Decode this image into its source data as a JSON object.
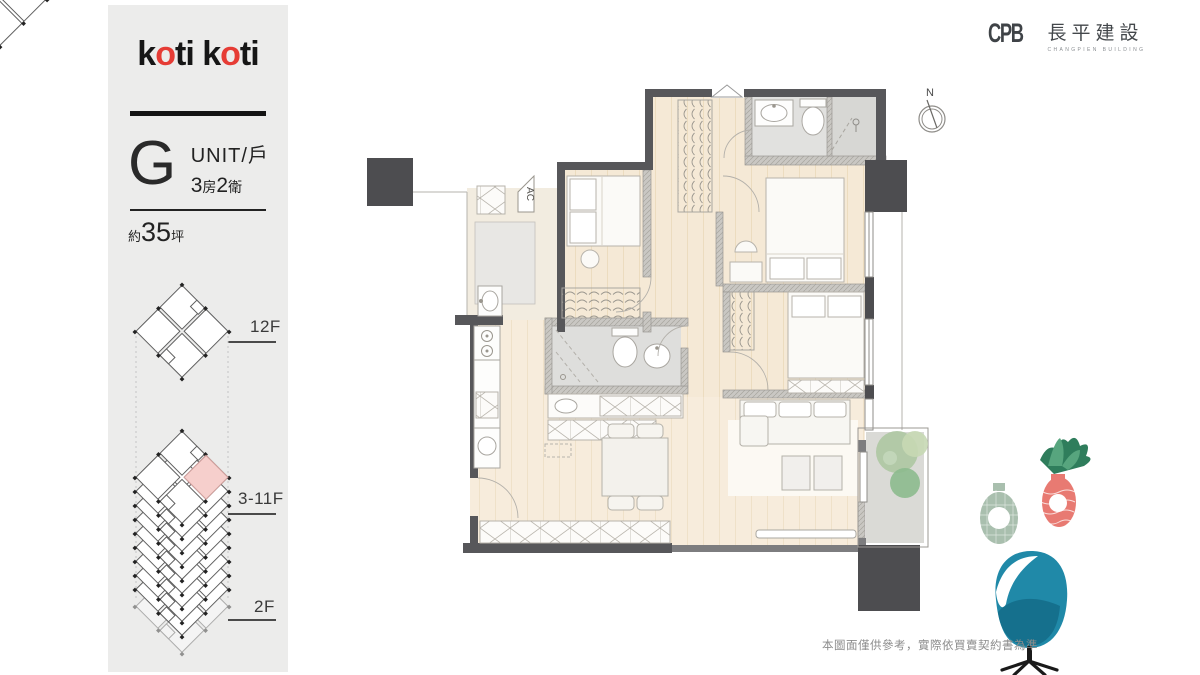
{
  "sidebar": {
    "logo": {
      "p1": "k",
      "p2": "o",
      "p3": "ti k",
      "p4": "o",
      "p5": "ti"
    },
    "unit": {
      "letter": "G",
      "label": "UNIT/戶",
      "rooms_num": "3",
      "rooms_unit": "房",
      "baths_num": "2",
      "baths_unit": "衛"
    },
    "area": {
      "prefix": "約",
      "value": "35",
      "unit": "坪"
    },
    "floors": [
      {
        "label": "12F"
      },
      {
        "label": "3-11F"
      },
      {
        "label": "2F"
      }
    ]
  },
  "header": {
    "logo_mark": "CPB",
    "company_name": "長平建設",
    "company_subtitle": "CHANGPIEN BUILDING"
  },
  "plan": {
    "ac_label": "AC",
    "north_label": "N"
  },
  "footer": {
    "disclaimer": "本圖面僅供參考，實際依買賣契約書為準"
  },
  "colors": {
    "brand_red": "#e63c35",
    "unit_highlight_pink": "#f6cfcc",
    "wall_gray": "#57575a",
    "column_gray": "#4d4d50",
    "floor_beige": "#f5e9d6",
    "teal_chair": "#2089a8",
    "coral_vase": "#e87a72",
    "sage_vase": "#a9bfae"
  }
}
